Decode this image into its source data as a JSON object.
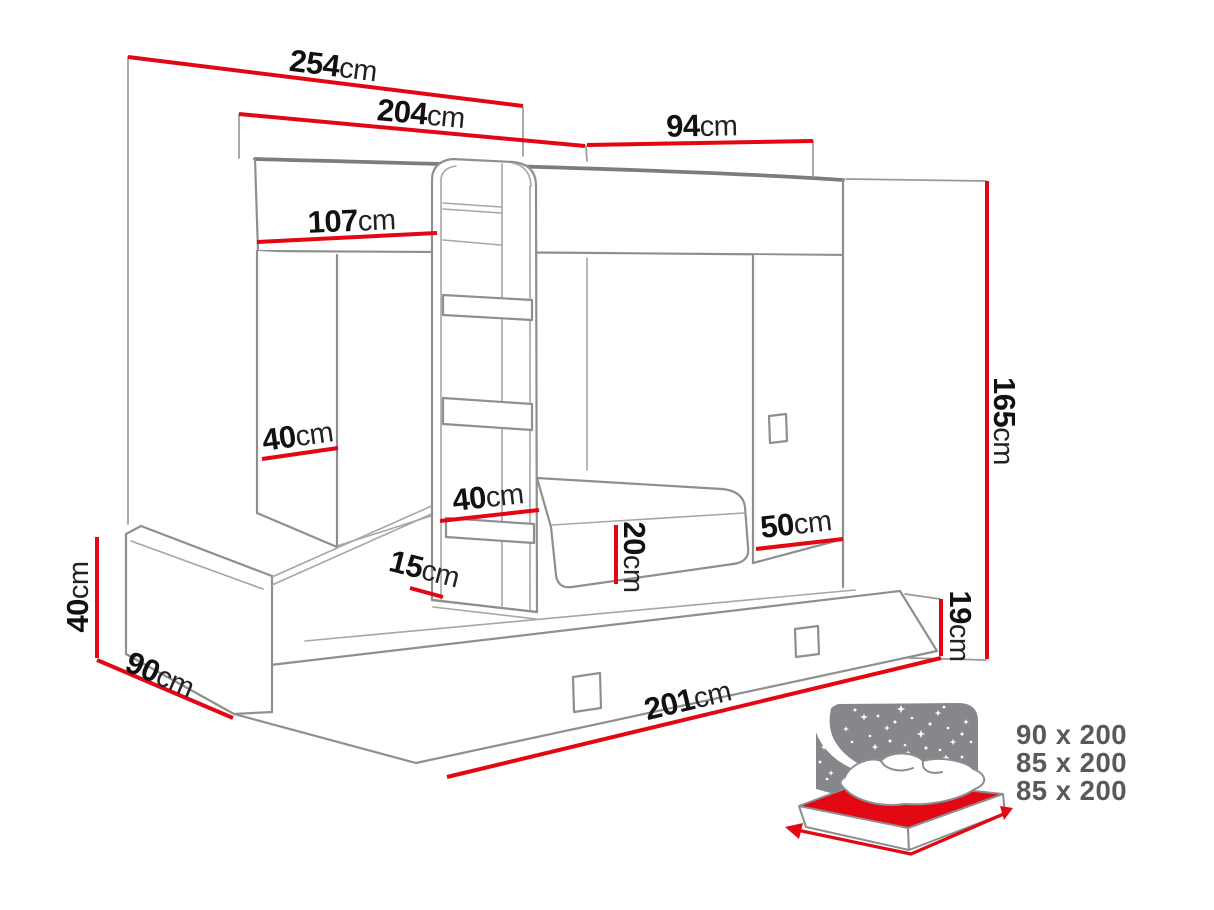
{
  "title": "Bunk bed with trundle - dimensions diagram",
  "dims": {
    "total_width": {
      "value": "254",
      "unit": "cm"
    },
    "upper_width": {
      "value": "204",
      "unit": "cm"
    },
    "upper_depth": {
      "value": "94",
      "unit": "cm"
    },
    "headboard_width": {
      "value": "107",
      "unit": "cm"
    },
    "shelf_gap": {
      "value": "40",
      "unit": "cm"
    },
    "ladder_width": {
      "value": "40",
      "unit": "cm"
    },
    "plinth_height": {
      "value": "15",
      "unit": "cm"
    },
    "mattress_height": {
      "value": "20",
      "unit": "cm"
    },
    "panel_width": {
      "value": "50",
      "unit": "cm"
    },
    "total_height": {
      "value": "165",
      "unit": "cm"
    },
    "drawer_height": {
      "value": "19",
      "unit": "cm"
    },
    "bed_length": {
      "value": "201",
      "unit": "cm"
    },
    "side_depth": {
      "value": "90",
      "unit": "cm"
    },
    "base_height": {
      "value": "40",
      "unit": "cm"
    }
  },
  "mattress_sizes": [
    "90 x 200",
    "85 x 200",
    "85 x 200"
  ],
  "icons": {
    "bed": "night-bed-icon"
  },
  "colors": {
    "dimension_red": "#e30613",
    "outline_gray": "#8f8f8f",
    "label_black": "#111111",
    "icon_gray": "#85878a",
    "size_text_gray": "#58595b"
  }
}
